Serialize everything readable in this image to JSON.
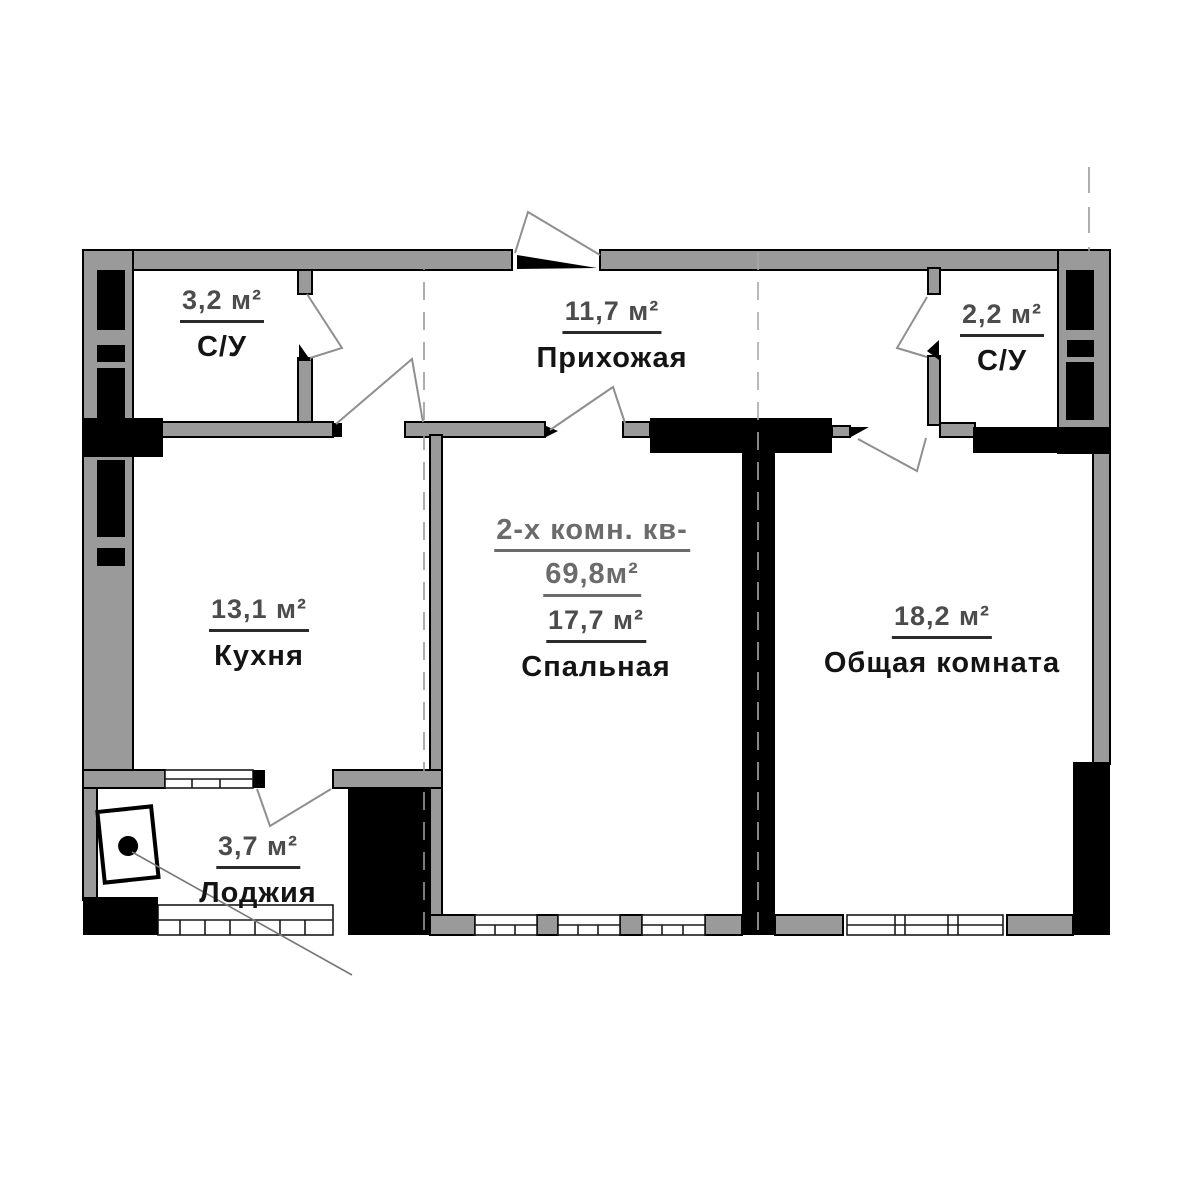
{
  "plan": {
    "title_line1": "2-х комн. кв-",
    "title_line2": "69,8м²",
    "rooms": [
      {
        "name": "С/У",
        "area": "3,2 м²"
      },
      {
        "name": "Прихожая",
        "area": "11,7 м²"
      },
      {
        "name": "С/У",
        "area": "2,2 м²"
      },
      {
        "name": "Кухня",
        "area": "13,1 м²"
      },
      {
        "name": "Спальная",
        "area": "17,7 м²"
      },
      {
        "name": "Общая комната",
        "area": "18,2 м²"
      },
      {
        "name": "Лоджия",
        "area": "3,7 м²"
      }
    ],
    "colors": {
      "wall_fill": "#9a9a9a",
      "column_fill": "#000000",
      "area_text": "#4c4c4c",
      "room_text": "#141414",
      "title_text": "#6b6b6b",
      "door_swing": "#8f8f8f"
    }
  }
}
